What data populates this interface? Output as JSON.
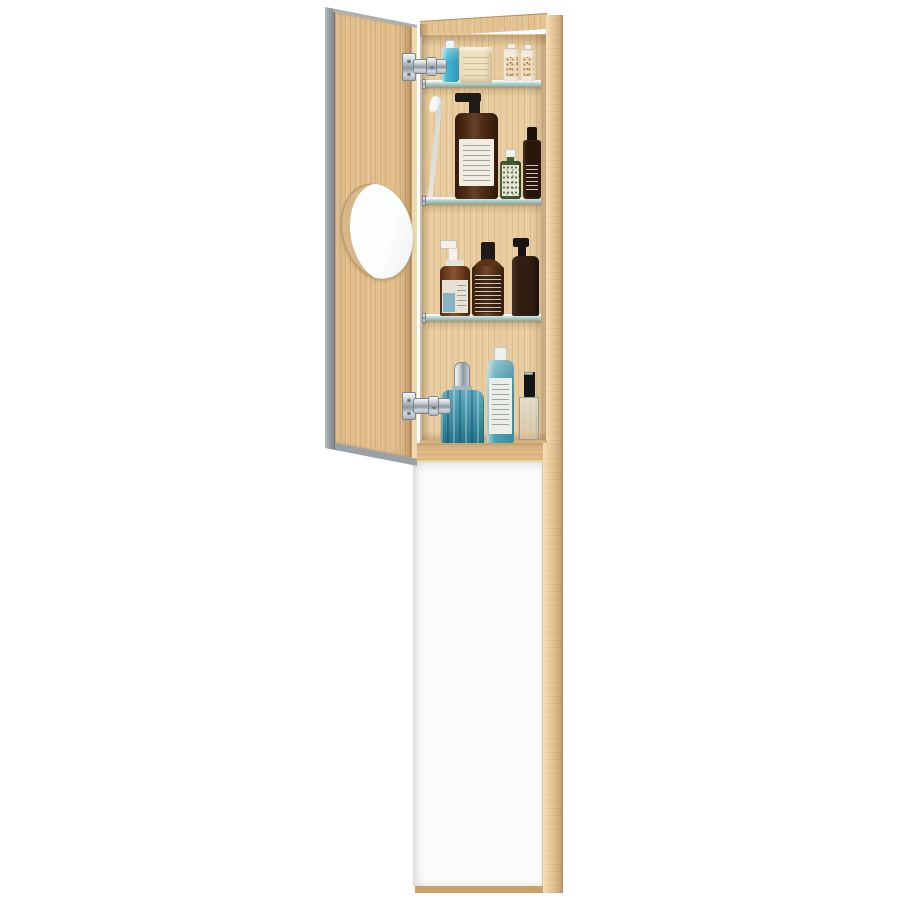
{
  "scene": {
    "description": "Tall oak bathroom cabinet photographed on white: upper compartment with open mirrored door revealing three glass shelves of toiletries, round inset shaving mirror on the door's inner face, chrome concealed hinges, and a tall closed white lower door in an oak frame",
    "background": "#ffffff"
  },
  "cabinet": {
    "material": "oak",
    "upper_section": "open mirrored door, oak interior, 3 glass shelves, chrome hinges",
    "lower_section": "closed white door panel with oak side frame",
    "door_mirror": "round magnifying mirror inset in door inner face"
  },
  "colors": {
    "wood": "#E4C392",
    "wood_back_panel": "#E9CDA0",
    "wood_door_face": "#E2BF8C",
    "wood_stile": "#E9CB9C",
    "wood_floor": "#E8C794",
    "wood_rail": "#DFBC87",
    "wood_bottom_lip": "#C9A267",
    "wood_light": "#EFD9AE",
    "mirror_edge_gray": "#9AA1A6",
    "mirror_reflection_tan": "#D7B78A",
    "white_door": "#FCFCFB",
    "glass_shelf": "#BFD9D2",
    "chrome": "#C2CAD0",
    "mouthwash_blue": "#3FB4D4",
    "mouthwash_cap": "#EFF5F6",
    "soap_cream": "#EDE0BE",
    "mini_bottle_white": "#F3EDE0",
    "mini_label_tan": "#EADBBE",
    "toothbrush_handle": "#D8DFE3",
    "pump_black": "#1F1B17",
    "pump_bottle_amber": "#4F2B12",
    "pump_bottle_label": "#F1EDE2",
    "green_bottle": "#475F3B",
    "green_bottle_label": "#E8E6D6",
    "dark_bottle": "#2A1609",
    "spray_pump_white": "#F4F2EA",
    "spray_bottle_amber": "#74411E",
    "spray_label": "#E7E2D6",
    "spray_label_blue": "#85B5C4",
    "amber_bottle": "#5E3315",
    "dark_pump_bottle": "#31201243",
    "dark_pump_body": "#311E12",
    "blue_glass": "#2B8FA6",
    "shampoo_teal": "#4BA2B1",
    "shampoo_cap": "#EDF2F0",
    "shampoo_label": "#E9EEE8",
    "perfume_cap": "#141414"
  },
  "items": [
    {
      "name": "mouthwash-bottle",
      "shelf": "top",
      "color": "#3FB4D4"
    },
    {
      "name": "soap-bar-block",
      "shelf": "top",
      "color": "#EDE0BE"
    },
    {
      "name": "mini-lotion-bottle-1",
      "shelf": "top",
      "color": "#F3EDE0"
    },
    {
      "name": "mini-lotion-bottle-2",
      "shelf": "top",
      "color": "#F3EDE0"
    },
    {
      "name": "toothbrush",
      "shelf": "second",
      "color": "#D8DFE3"
    },
    {
      "name": "amber-pump-bottle-large",
      "shelf": "second",
      "color": "#4F2B12"
    },
    {
      "name": "green-tonic-bottle",
      "shelf": "second",
      "color": "#475F3B"
    },
    {
      "name": "dark-spray-bottle",
      "shelf": "second",
      "color": "#2A1609"
    },
    {
      "name": "amber-spray-bottle",
      "shelf": "third",
      "color": "#74411E"
    },
    {
      "name": "amber-label-bottle",
      "shelf": "third",
      "color": "#5E3315"
    },
    {
      "name": "dark-pump-bottle",
      "shelf": "third",
      "color": "#311E12"
    },
    {
      "name": "blue-glass-bottle",
      "shelf": "bottom",
      "color": "#2B8FA6"
    },
    {
      "name": "teal-shampoo-bottle",
      "shelf": "bottom",
      "color": "#4BA2B1"
    },
    {
      "name": "perfume-bottle",
      "shelf": "bottom",
      "color": "#141414"
    }
  ]
}
